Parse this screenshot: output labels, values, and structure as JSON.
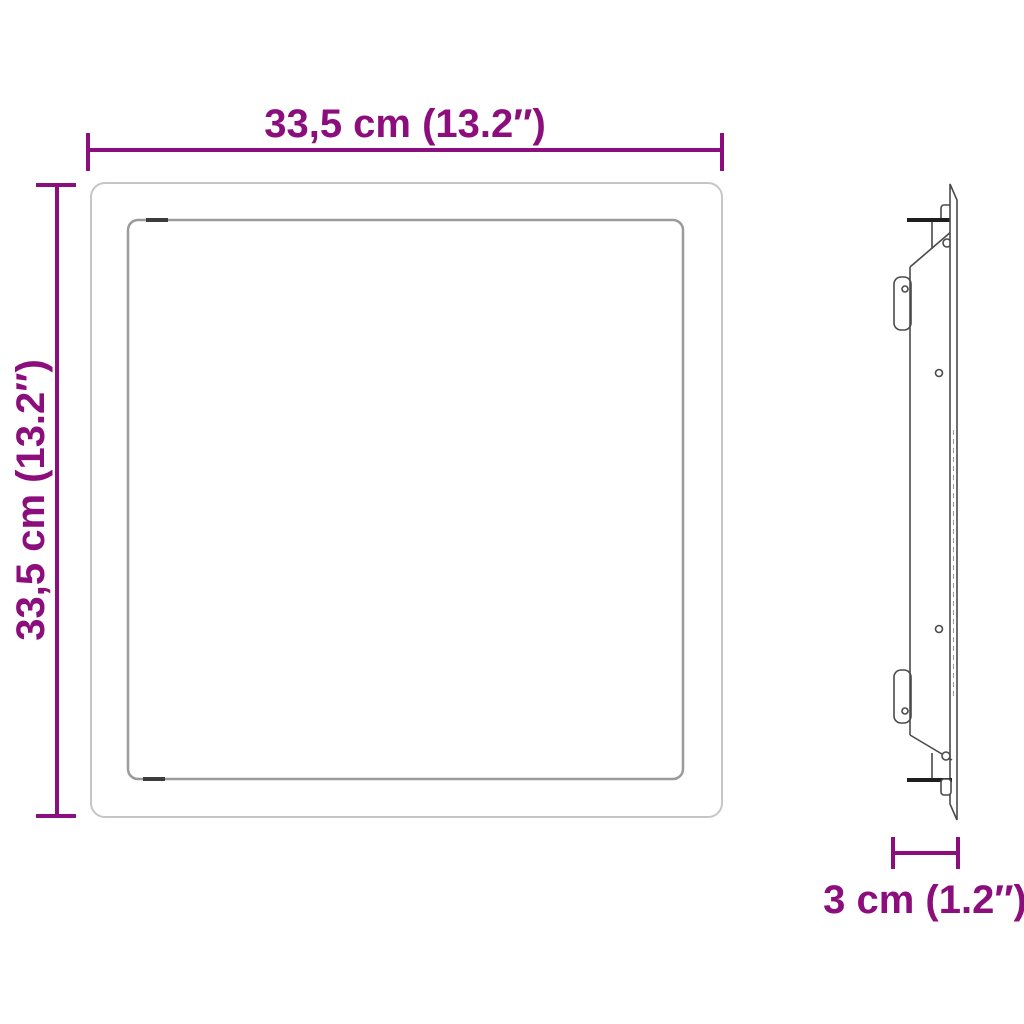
{
  "diagram": {
    "type": "product-dimension-drawing",
    "background_color": "#ffffff",
    "accent_color": "#8B0E7C",
    "line_colors": {
      "outer_frame": "#c6c6c6",
      "inner_frame": "#9b9b9b",
      "side_view": "#4a4a4a"
    },
    "views": {
      "front_view": "square access panel with inner door frame",
      "side_view": "thin side profile with mounting clips"
    },
    "width_dim": {
      "label": "33,5 cm (13.2″)"
    },
    "height_dim": {
      "label": "33,5 cm (13.2″)"
    },
    "depth_dim": {
      "label": "3 cm (1.2″)"
    }
  }
}
